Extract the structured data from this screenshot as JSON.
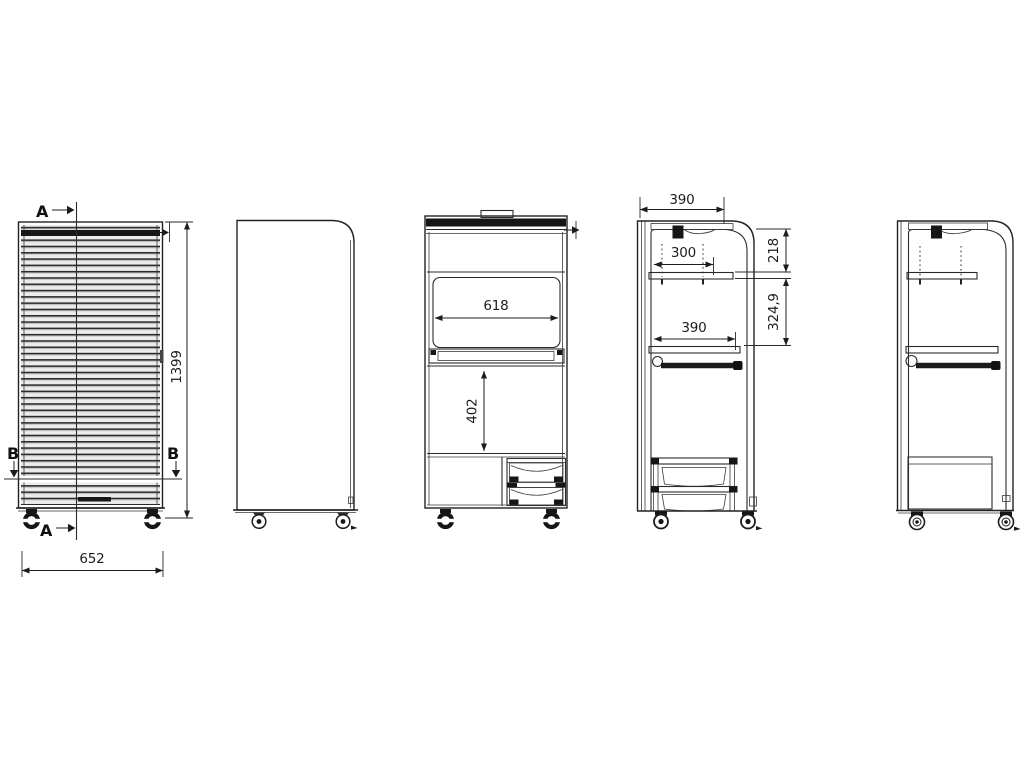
{
  "colors": {
    "background": "#ffffff",
    "line": "#222222",
    "dark_fill": "#161616",
    "slat_light": "#ececec"
  },
  "sections": {
    "a": "A",
    "b": "B"
  },
  "dims": {
    "overall_width": "652",
    "overall_height": "1399",
    "opening_width": "618",
    "opening_height": "402",
    "depth_top": "390",
    "shelf_depth": "300",
    "top_to_shelf": "218",
    "shelf_to_tray": "324,9",
    "tray_depth": "390"
  }
}
